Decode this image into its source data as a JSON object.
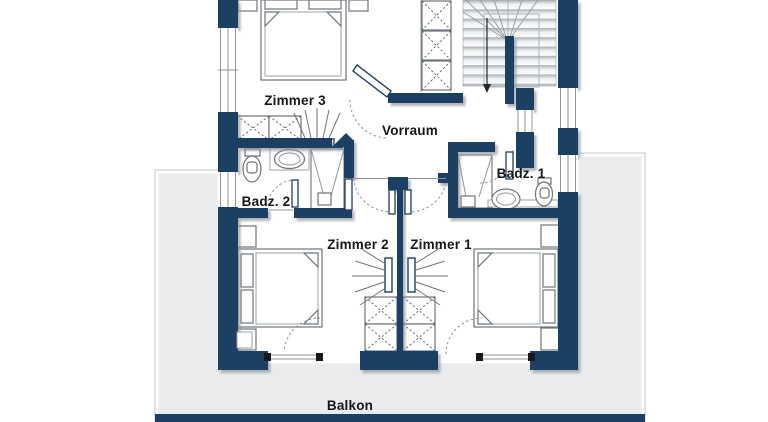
{
  "document": {
    "type": "floor-plan",
    "view": "upper-floor-apartment"
  },
  "colors": {
    "wall_navy": "#1c3f63",
    "terrace_gray": "#e9ebec",
    "paper_white": "#ffffff",
    "furniture_line": "#6f747b",
    "label_text": "#15161a"
  },
  "rooms": {
    "zimmer3": {
      "label": "Zimmer 3"
    },
    "vorraum": {
      "label": "Vorraum"
    },
    "badz2": {
      "label": "Badz. 2"
    },
    "badz1": {
      "label": "Badz. 1"
    },
    "zimmer2": {
      "label": "Zimmer 2"
    },
    "zimmer1": {
      "label": "Zimmer 1"
    },
    "balkon": {
      "label": "Balkon"
    }
  },
  "fixtures": {
    "beds": [
      "double-bed-zimmer3",
      "double-bed-zimmer2",
      "double-bed-zimmer1"
    ],
    "bathroom2": [
      "toilet",
      "washbasin",
      "shower"
    ],
    "bathroom1": [
      "shower",
      "washbasin",
      "toilet"
    ],
    "storage": [
      "wardrobe-zimmer3",
      "wardrobe-zimmer2",
      "wardrobe-zimmer1",
      "shaft-cabinet"
    ],
    "heating": [
      "radiator-zimmer3",
      "radiator-zimmer2",
      "radiator-zimmer1"
    ],
    "circulation": [
      "u-shaped-staircase",
      "stair-direction-arrow",
      "door-swings",
      "balcony-doors",
      "windows"
    ]
  }
}
